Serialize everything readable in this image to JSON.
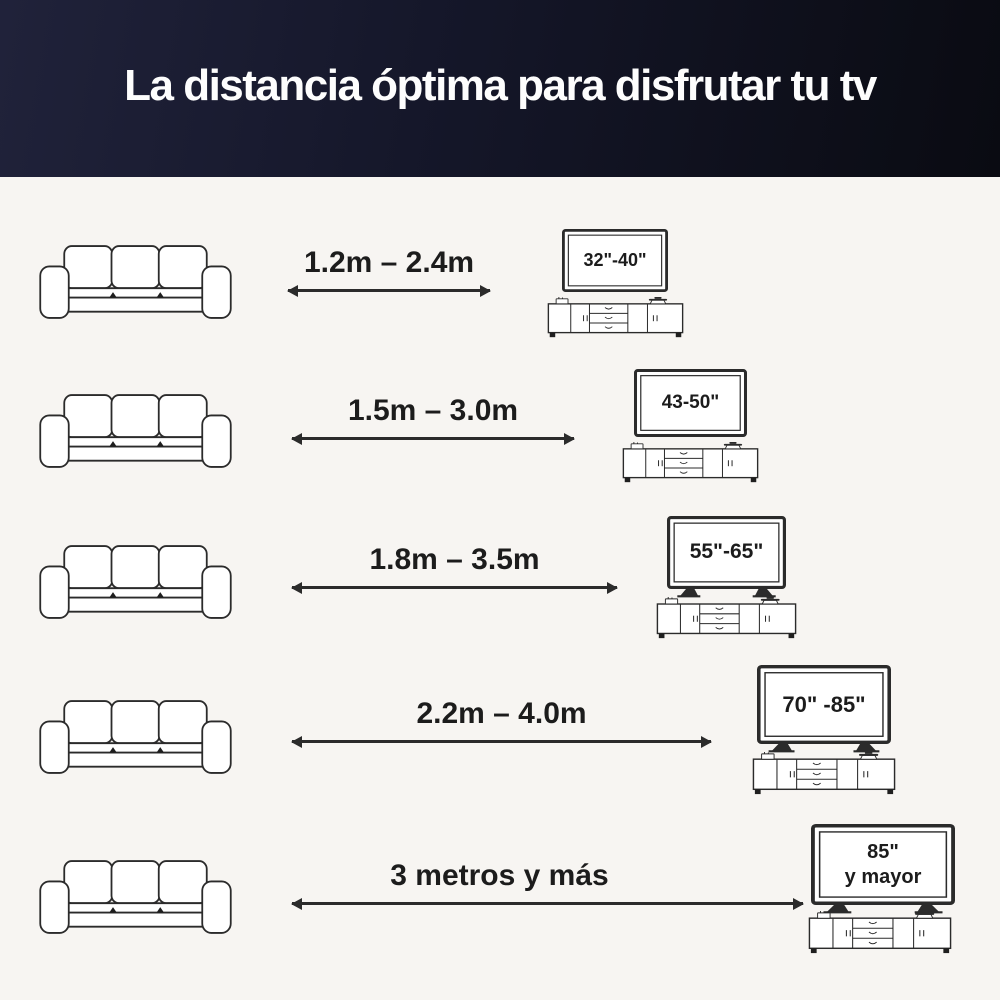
{
  "header": {
    "title": "La distancia óptima para disfrutar tu tv"
  },
  "rows": [
    {
      "distance": "1.2m – 2.4m",
      "tv_size": "32\"-40\""
    },
    {
      "distance": "1.5m – 3.0m",
      "tv_size": "43-50\""
    },
    {
      "distance": "1.8m – 3.5m",
      "tv_size": "55\"-65\""
    },
    {
      "distance": "2.2m – 4.0m",
      "tv_size": "70\" -85\""
    },
    {
      "distance": "3 metros y más",
      "tv_size": "85\"\ny mayor"
    }
  ],
  "icons": {
    "sofa": "sofa-icon",
    "tv": "tv-icon",
    "tv_stand": "tv-stand-icon",
    "arrow": "double-headed-arrow-icon"
  },
  "colors": {
    "header_bg_left": "#20223a",
    "header_bg_right": "#0a0b12",
    "title_text": "#fdfdfd",
    "canvas_bg": "#f7f5f2",
    "line_art_ink": "#2b2b2b",
    "label_text": "#1c1c1c"
  }
}
